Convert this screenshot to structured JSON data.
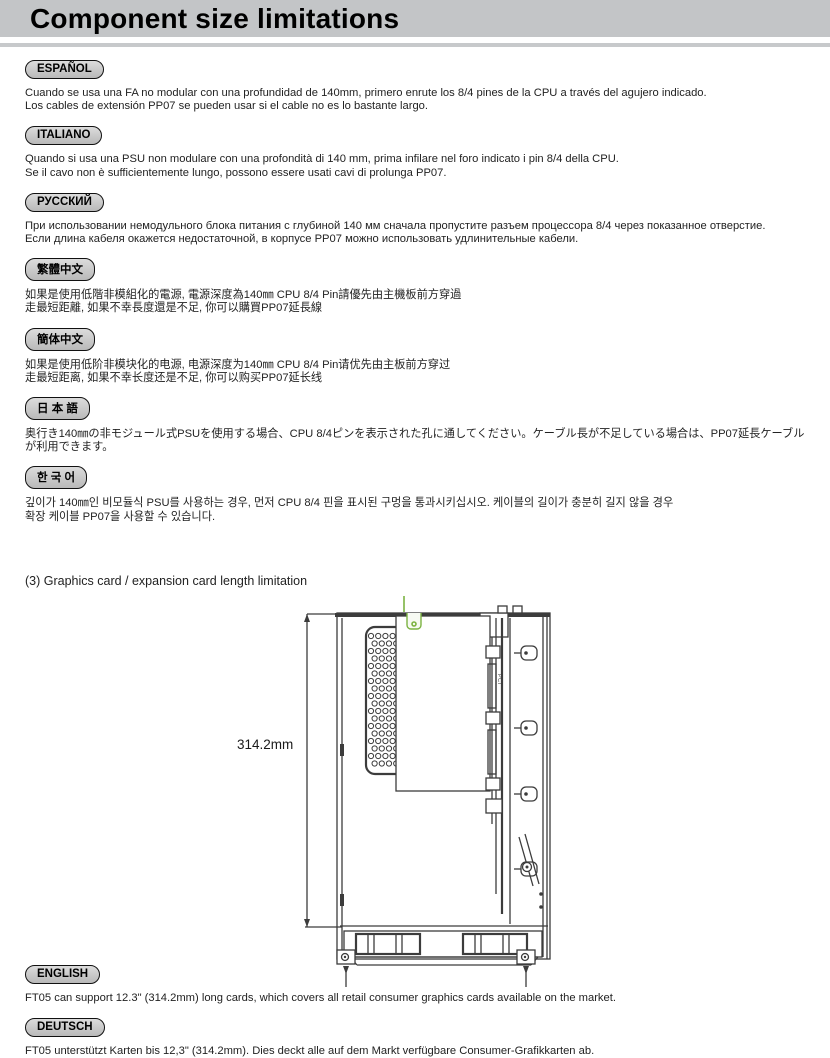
{
  "header": {
    "title": "Component size limitations"
  },
  "sections": [
    {
      "badge": "ESPAÑOL",
      "lines": [
        "Cuando se usa una FA no modular con una profundidad de 140mm, primero enrute los 8/4 pines de la CPU a través del agujero indicado.",
        "Los cables de extensión PP07 se pueden usar si el cable no es lo bastante largo."
      ]
    },
    {
      "badge": "ITALIANO",
      "lines": [
        "Quando si usa una PSU non modulare con una profondità di 140 mm, prima infilare nel foro indicato i pin 8/4 della CPU.",
        "Se il cavo non è sufficientemente lungo, possono essere usati cavi di prolunga PP07."
      ]
    },
    {
      "badge": "РУССКИЙ",
      "lines": [
        "При использовании немодульного блока питания с глубиной 140 мм сначала пропустите разъем процессора 8/4 через показанное отверстие.",
        "Если длина кабеля окажется недостаточной, в корпусе PP07 можно использовать удлинительные кабели."
      ]
    },
    {
      "badge": "繁體中文",
      "lines": [
        "如果是使用低階非模組化的電源, 電源深度為140㎜ CPU 8/4 Pin請優先由主機板前方穿過",
        "走最短距離, 如果不幸長度還是不足, 你可以購買PP07延長線"
      ]
    },
    {
      "badge": "簡体中文",
      "lines": [
        "如果是使用低阶非模块化的电源, 电源深度为140㎜ CPU 8/4 Pin请优先由主板前方穿过",
        "走最短距离, 如果不幸长度还是不足, 你可以购买PP07延长线"
      ]
    },
    {
      "badge": "日 本 語",
      "lines": [
        "奥行き140㎜の非モジュール式PSUを使用する場合、CPU 8/4ピンを表示された孔に通してください。ケーブル長が不足している場合は、PP07延長ケーブルが利用できます。"
      ]
    },
    {
      "badge": "한 국 어",
      "lines": [
        "깊이가 140㎜인 비모듈식 PSU를 사용하는 경우, 먼저 CPU 8/4 핀을 표시된 구멍을 통과시키십시오. 케이블의 길이가 충분히 길지 않을 경우",
        "확장 케이블 PP07을 사용할 수 있습니다."
      ]
    }
  ],
  "figure": {
    "heading": "(3) Graphics card / expansion card length limitation",
    "dimension_label": "314.2mm",
    "pci_label": "PCI",
    "accent_green": "#7cb342",
    "line_color": "#3c3c3c"
  },
  "bottom_sections": [
    {
      "badge": "ENGLISH",
      "lines": [
        "FT05 can support 12.3\" (314.2mm) long cards, which covers all retail consumer graphics cards available on the market."
      ]
    },
    {
      "badge": "DEUTSCH",
      "lines": [
        "FT05 unterstützt Karten bis 12,3\" (314.2mm). Dies deckt alle auf dem Markt verfügbare Consumer-Grafikkarten ab."
      ]
    }
  ]
}
